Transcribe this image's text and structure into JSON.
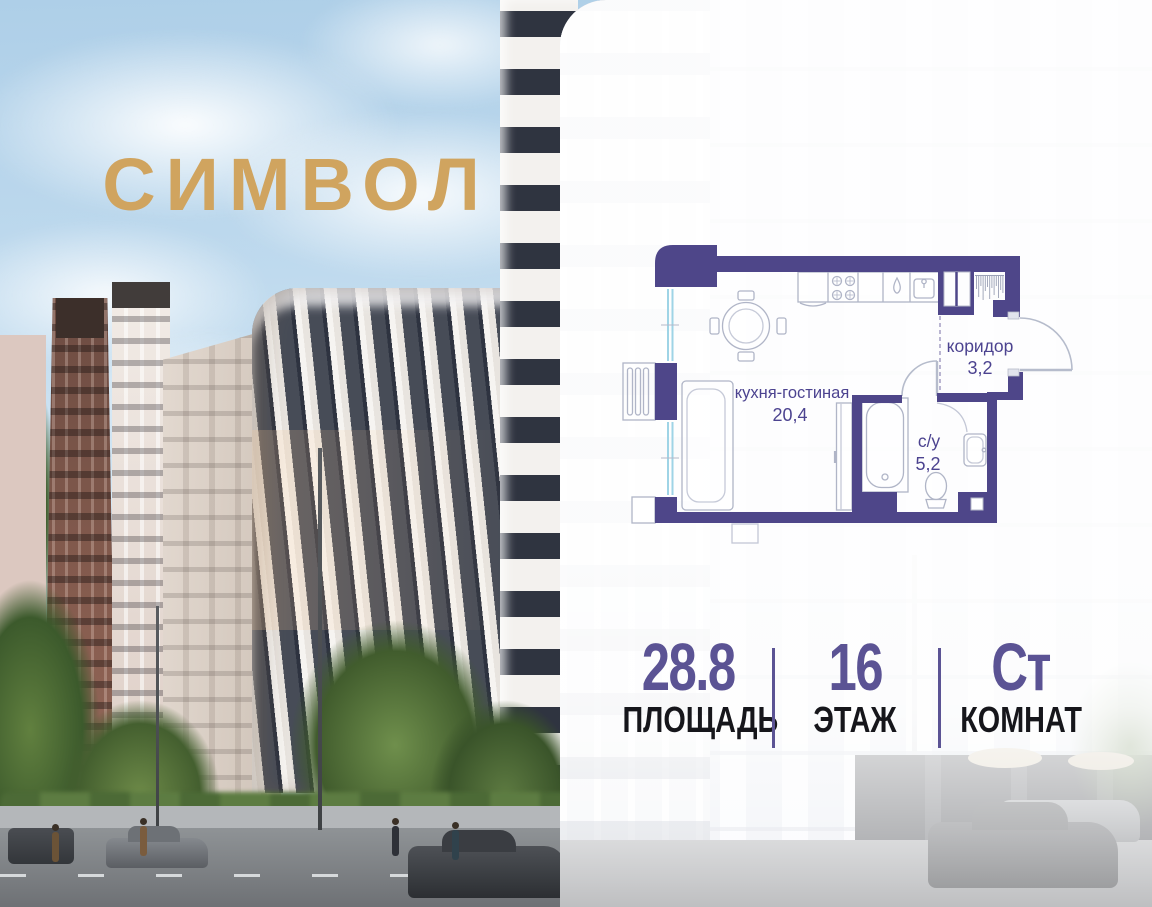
{
  "brand": {
    "logo_text": "СИМВОЛ",
    "logo_color": "#d0a45f"
  },
  "floor_plan": {
    "wall_color": "#4e4689",
    "label_color": "#4c4390",
    "rooms": [
      {
        "name": "кухня-гостиная",
        "area": "20,4"
      },
      {
        "name": "коридор",
        "area": "3,2"
      },
      {
        "name": "с/у",
        "area": "5,2"
      }
    ]
  },
  "stats": {
    "accent_color": "#5b5394",
    "items": [
      {
        "value": "28.8",
        "label": "ПЛОЩАДЬ"
      },
      {
        "value": "16",
        "label": "ЭТАЖ"
      },
      {
        "value": "Ст",
        "label": "КОМНАТ"
      }
    ]
  }
}
